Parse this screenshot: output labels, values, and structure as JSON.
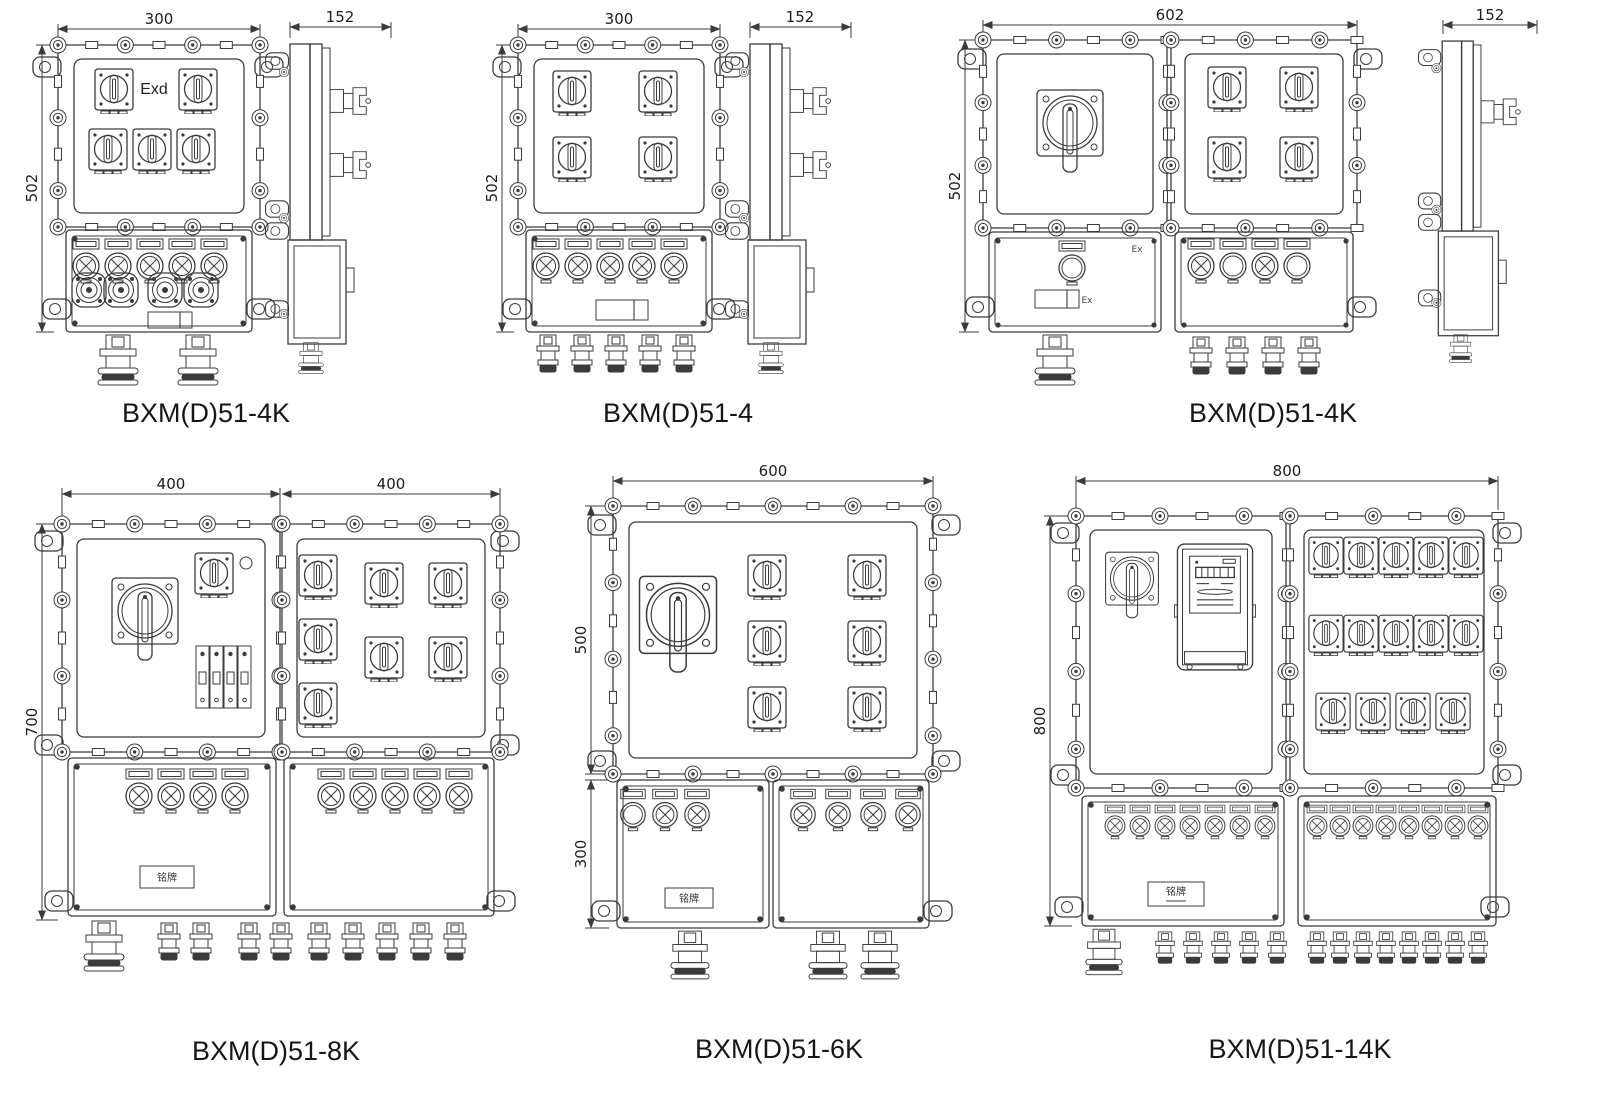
{
  "page": {
    "background": "#ffffff",
    "ink": "#3b3b3b",
    "sheet_type": "dimension drawings of explosion-proof distribution boxes"
  },
  "units": [
    {
      "id": "u1",
      "label": "BXM(D)51-4K",
      "marking": "Exd",
      "dims": {
        "width": "300",
        "height": "502",
        "depth": "152"
      },
      "components": {
        "branch_switches": 5,
        "indicator_lamps": 5,
        "sockets": 4,
        "bottom_glands": 2,
        "views": "front+side"
      }
    },
    {
      "id": "u2",
      "label": "BXM(D)51-4",
      "dims": {
        "width": "300",
        "height": "502",
        "depth": "152"
      },
      "components": {
        "branch_switches": 4,
        "indicator_lamps": 5,
        "bottom_glands": 5,
        "views": "front+side"
      }
    },
    {
      "id": "u3",
      "label": "BXM(D)51-4K",
      "ex_mark": "Ex",
      "dims": {
        "width": "602",
        "height": "502",
        "depth": "152"
      },
      "components": {
        "main_switch": 1,
        "branch_switches": 4,
        "push_buttons": 3,
        "indicator_lamps": 2,
        "bottom_glands": 5,
        "views": "front+side"
      }
    },
    {
      "id": "u4",
      "label": "BXM(D)51-8K",
      "nameplate": "铭牌",
      "dims": {
        "width_left": "400",
        "width_right": "400",
        "height": "700"
      },
      "components": {
        "main_switch": 1,
        "aux_switch": 1,
        "breaker_4pole": 1,
        "branch_switches": 7,
        "indicator_lamps": 9,
        "bottom_glands": 10,
        "views": "front"
      }
    },
    {
      "id": "u5",
      "label": "BXM(D)51-6K",
      "nameplate": "铭牌",
      "dims": {
        "width": "600",
        "height_upper": "500",
        "height_lower": "300"
      },
      "components": {
        "main_switch": 1,
        "branch_switches": 6,
        "push_buttons": 1,
        "indicator_lamps": 6,
        "bottom_glands": 3,
        "views": "front"
      }
    },
    {
      "id": "u6",
      "label": "BXM(D)51-14K",
      "nameplate": "铭牌",
      "dims": {
        "width": "800",
        "height": "800"
      },
      "components": {
        "main_switch": 1,
        "energy_meter": 1,
        "branch_switches": 14,
        "indicator_lamps": 15,
        "bottom_glands": 14,
        "views": "front"
      }
    }
  ]
}
